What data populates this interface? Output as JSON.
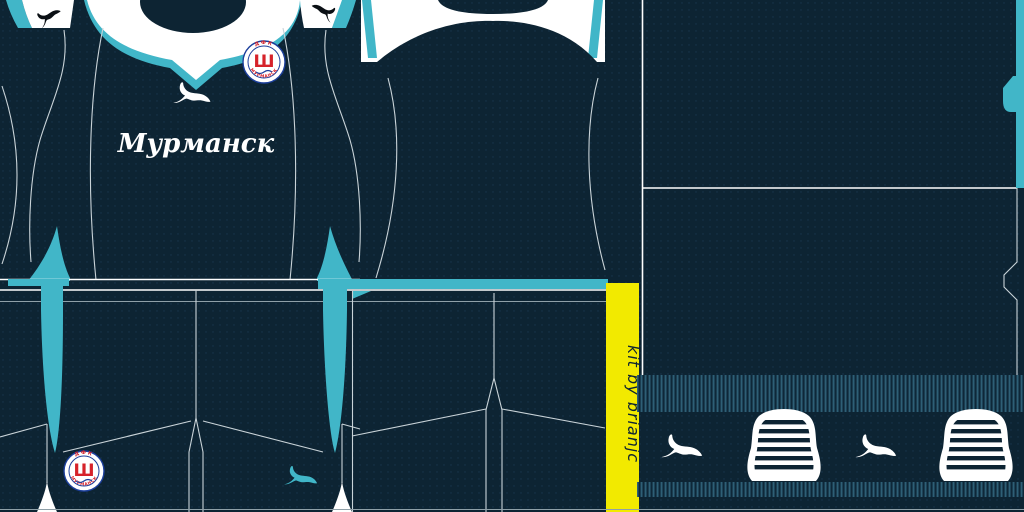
{
  "kit": {
    "shirt_front": {
      "club_city_text": "Мурманск"
    },
    "credit_strip": {
      "text": "kit by brianjc"
    },
    "badge": {
      "letter": "Ш",
      "top_text": "ДФК",
      "bottom_text": "МУРМАНСК"
    },
    "icons": {
      "brand": "puma-cat",
      "chest_logo_color": "#ffffff",
      "cuff_logo_color": "#0a0f14",
      "shorts_logo_color": "#41b6c8",
      "sock_logo_color": "#ffffff"
    },
    "colors": {
      "navy": "#0d2433",
      "teal": "#41b6c8",
      "yellow": "#f2ea00",
      "white": "#ffffff",
      "badge_red": "#d6222a",
      "badge_blue": "#1c3f9c",
      "rib_stripe": "#2e5f76",
      "seam_gray": "#c9d3d8"
    }
  }
}
